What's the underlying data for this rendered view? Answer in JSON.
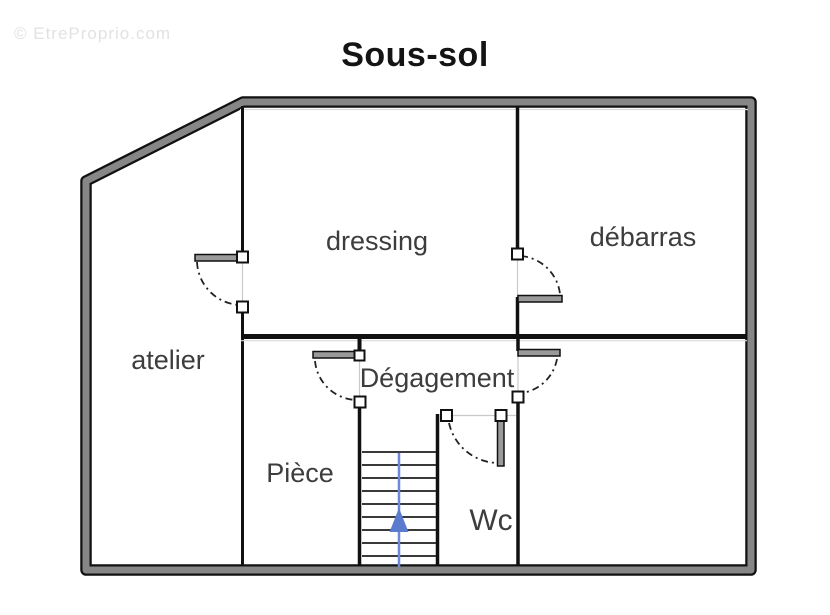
{
  "watermark": {
    "text": "© EtreProprio.com"
  },
  "title": "Sous-sol",
  "rooms": {
    "atelier": {
      "label": "atelier"
    },
    "dressing": {
      "label": "dressing"
    },
    "debarras": {
      "label": "débarras"
    },
    "degagement": {
      "label": "Dégagement"
    },
    "piece": {
      "label": "Pièce"
    },
    "wc": {
      "label": "Wc"
    }
  },
  "stairs": {
    "tread_count": 9,
    "arrow_direction": "up",
    "arrow_color": "#5b7bce"
  },
  "colors": {
    "outer_wall_fill": "#868686",
    "wall_edge": "#111111",
    "room_label": "#3d3d3d",
    "watermark": "#e2e2e2",
    "title": "#141414"
  }
}
